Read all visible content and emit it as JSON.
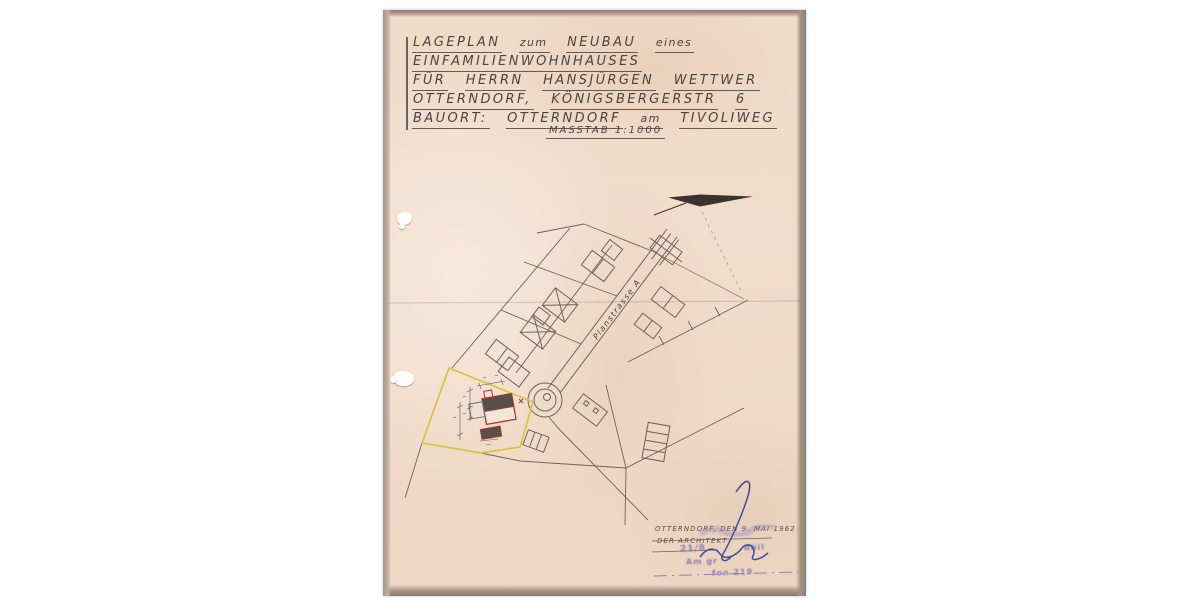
{
  "title_block": {
    "lines": [
      [
        "LAGEPLAN",
        "zum",
        "NEUBAU",
        "eines"
      ],
      [
        "EINFAMILIENWOHNHAUSES"
      ],
      [
        "FÜR",
        "HERRN",
        "HANSJÜRGEN",
        "WETTWER"
      ],
      [
        "OTTERNDORF,",
        "KÖNIGSBERGERSTR",
        "6"
      ],
      [
        "BAUORT:",
        "OTTERNDORF",
        "am",
        "TIVOLIWEG"
      ]
    ],
    "scale_label": "MASSTAB 1:1000"
  },
  "plan": {
    "street_label": "Planstrasse A",
    "plot_outline_color": "#d8c53d",
    "new_building_color": "#a93636",
    "pencil_color": "#6f635c"
  },
  "signature_block": {
    "line1": "OTTERNDORF, DEN 9. MAI 1962",
    "line2": "DER ARCHITEKT",
    "stamp_fragments": {
      "a": "21/8",
      "b": "dbil",
      "c": "Am gr",
      "d": "fon 219"
    },
    "stamp_color": "#7e6cb4",
    "ink_color": "#3b4fa0"
  }
}
